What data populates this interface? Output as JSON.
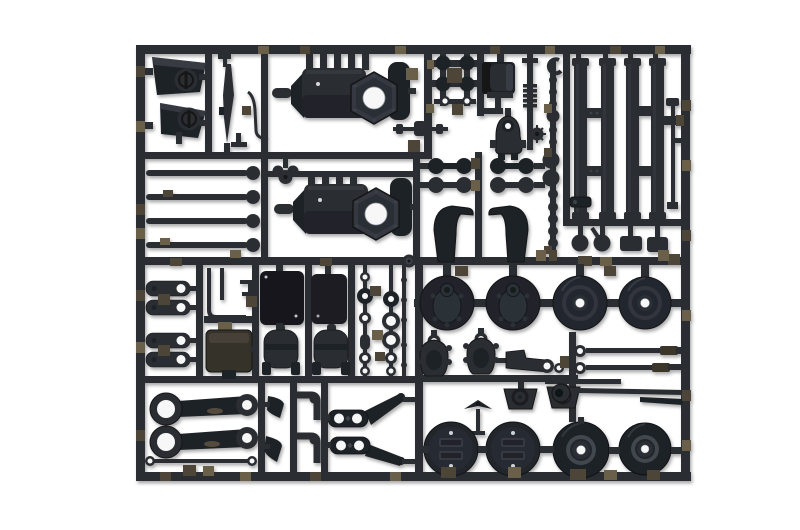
{
  "meta": {
    "type": "product-photograph",
    "subject": "Injection-molded black plastic model kit sprue (runner frame) holding unassembled truck model parts on a white seamless background",
    "text_visible": "none"
  },
  "palette": {
    "background": "#ffffff",
    "plastic": "#2a2d33",
    "plastic_dark": "#1e2127",
    "plastic_darker": "#121418",
    "plastic_light": "#3d424a",
    "plastic_highlight": "#565c66",
    "gate_brown": "#4e4537",
    "gate_brown_light": "#6b5e49",
    "hole": "#f7f7f7"
  },
  "parts": {
    "frame_label": "Rectangular sprue frame with runner bars",
    "groups": [
      {
        "id": "headlight-panels",
        "label": "Two angular lamp panel parts with round lens bosses",
        "count": 2
      },
      {
        "id": "exhaust-blade",
        "label": "Thin tapered exhaust stack part",
        "count": 1
      },
      {
        "id": "wire-lever",
        "label": "Bent wire lever part with bracket",
        "count": 1
      },
      {
        "id": "tie-rods",
        "label": "Four long tie rods with ball ends",
        "count": 4
      },
      {
        "id": "wing-nut",
        "label": "Small winged valve knob",
        "count": 1
      },
      {
        "id": "axle-housings",
        "label": "Two large axle/gearbox housings with hexagonal flange and through-hole",
        "count": 2
      },
      {
        "id": "knob-cluster",
        "label": "Cluster of small round knobs and o-rings",
        "count": 6
      },
      {
        "id": "winch-drum",
        "label": "Winch drum unit",
        "count": 1
      },
      {
        "id": "coil-spring",
        "label": "Stacked coil spring part",
        "count": 1
      },
      {
        "id": "c-clip",
        "label": "C-shaped clip",
        "count": 1
      },
      {
        "id": "mini-driveshaft",
        "label": "Short driveshaft rod",
        "count": 1
      },
      {
        "id": "motor-dome",
        "label": "Bell-shaped motor mount with hole",
        "count": 1
      },
      {
        "id": "star-gear",
        "label": "Small spiked gear wheel",
        "count": 1
      },
      {
        "id": "ball-chain",
        "label": "Vertical runner with chain of round pegs",
        "count": 15
      },
      {
        "id": "dumbbell-links",
        "label": "Four dumbbell-shaped link parts",
        "count": 4
      },
      {
        "id": "beam-arms",
        "label": "Two arched walking-beam suspension arms",
        "count": 2
      },
      {
        "id": "ladder-frame",
        "label": "Four chassis rail bars with crossmembers and thin rod",
        "count": 4
      },
      {
        "id": "ladder-small-parts",
        "label": "Round knobs and rectangular pads below rails",
        "count": 4
      },
      {
        "id": "spring-shackles",
        "label": "Four spring shackle links with holes",
        "count": 4
      },
      {
        "id": "pipe-bracket",
        "label": "Thin bent pipe and step bracket",
        "count": 1
      },
      {
        "id": "battery-box",
        "label": "Rectangular battery box",
        "count": 1
      },
      {
        "id": "radiator-panels",
        "label": "Two dark rectangular tank/radiator panels",
        "count": 2
      },
      {
        "id": "air-tanks",
        "label": "Two cylindrical air tanks with feet",
        "count": 2
      },
      {
        "id": "small-rings",
        "label": "Columns of small rings and donut spacers",
        "count": 11
      },
      {
        "id": "leaf-spring-arms",
        "label": "Two long link arms with large ring ends",
        "count": 2
      },
      {
        "id": "thin-rod",
        "label": "Thin rod with small ring ends",
        "count": 1
      },
      {
        "id": "wedge-brackets",
        "label": "Two small wedge brackets",
        "count": 2
      },
      {
        "id": "elbow-fittings",
        "label": "Two L-shaped elbow fittings",
        "count": 2
      },
      {
        "id": "torque-arms",
        "label": "Two steering/torque arms with twin holes",
        "count": 2
      },
      {
        "id": "brake-drums",
        "label": "Two brake drum hubs with raised boss",
        "count": 2
      },
      {
        "id": "wheel-hubs",
        "label": "Two smooth wheel hubs with centre hole",
        "count": 2
      },
      {
        "id": "gearbox-covers",
        "label": "Two beetle-shaped gearbox covers",
        "count": 2
      },
      {
        "id": "bracket-arm",
        "label": "Bracket arm with eye end",
        "count": 1
      },
      {
        "id": "engine-mounts",
        "label": "Two trapezoid engine mounts with ring detail",
        "count": 2
      },
      {
        "id": "winged-valve",
        "label": "Tiny winged valve with stem",
        "count": 1
      },
      {
        "id": "long-rods",
        "label": "Three long rods with ring ends and sleeves",
        "count": 3
      },
      {
        "id": "road-wheels",
        "label": "Four road wheels (two slotted, two with centre hole)",
        "count": 4
      },
      {
        "id": "injection-gate",
        "label": "Round injection gate mark on centre runner",
        "count": 1
      },
      {
        "id": "sprue-gates",
        "label": "Brown cut gate pads along frame and runners",
        "count": 30
      }
    ]
  }
}
